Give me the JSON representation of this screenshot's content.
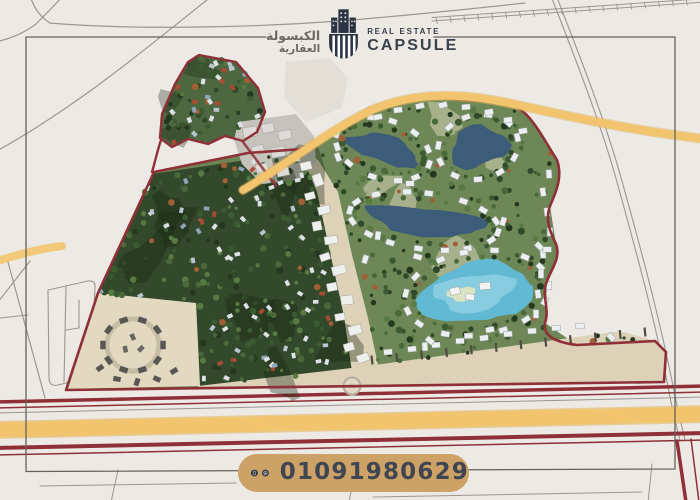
{
  "page": {
    "type": "real-estate-compound-masterplan-advert"
  },
  "logo": {
    "arabic_line1": "الكبسولة",
    "arabic_line2": "العقارية",
    "english_small": "REAL ESTATE",
    "english_large": "CAPSULE"
  },
  "contact": {
    "phone": "01091980629"
  },
  "map": {
    "colors": {
      "background": "#edeae5",
      "road_gray": "#9b978f",
      "highway_yellow": "#f2c46d",
      "highway_edge": "#e0b058",
      "boundary_red": "#8f3038",
      "parcel_base": "#6d8454",
      "forest_dark": "#33492b",
      "district_green": "#6d8756",
      "lake_blue": "#3d5c7a",
      "lagoon_blue": "#62b9d4",
      "lagoon_light": "#8fd0e0",
      "sand_beige": "#ddd2b8",
      "villa_white": "#eceff0",
      "frame_gray": "#63625c"
    }
  },
  "theme": {
    "pill_gold": "#cda266",
    "brand_navy": "#2b3442",
    "phone_text": "#3f4652"
  }
}
